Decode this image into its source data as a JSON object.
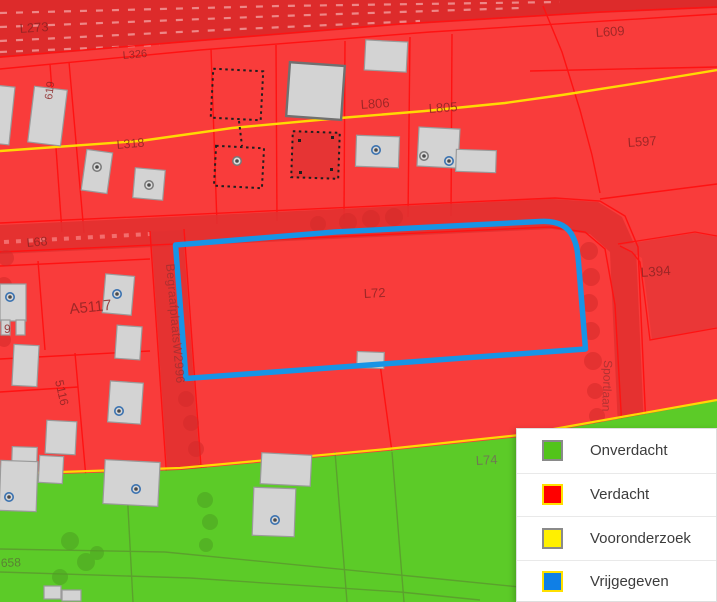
{
  "legend": {
    "items": [
      {
        "label": "Onverdacht",
        "swatch_color": "#52c41a",
        "swatch_border": "#8a8a8a"
      },
      {
        "label": "Verdacht",
        "swatch_color": "#ff0000",
        "swatch_border": "#ffe000"
      },
      {
        "label": "Vooronderzoek",
        "swatch_color": "#fff000",
        "swatch_border": "#8a8a8a"
      },
      {
        "label": "Vrijgegeven",
        "swatch_color": "#0f7fe6",
        "swatch_border": "#ffe000"
      }
    ]
  },
  "map": {
    "zone_colors": {
      "verdacht": "#f93c3b",
      "onverdacht": "#5ccb28",
      "vooronderzoek": "#ffd903",
      "vrijgegeven": "#1794e6"
    },
    "labels": {
      "l273": "L273",
      "l326": "L326",
      "n619": "619",
      "l318": "L318",
      "l806": "L806",
      "l805": "L805",
      "l609": "L609",
      "l597": "L597",
      "l68": "L68",
      "a5117": "A5117",
      "l394": "L394",
      "l72": "L72",
      "l74": "L74",
      "street": "BegraafplaatsW2996",
      "n5116": "5116",
      "sportlaan": "Sportlaan",
      "n658": "658",
      "n9": "9"
    }
  }
}
